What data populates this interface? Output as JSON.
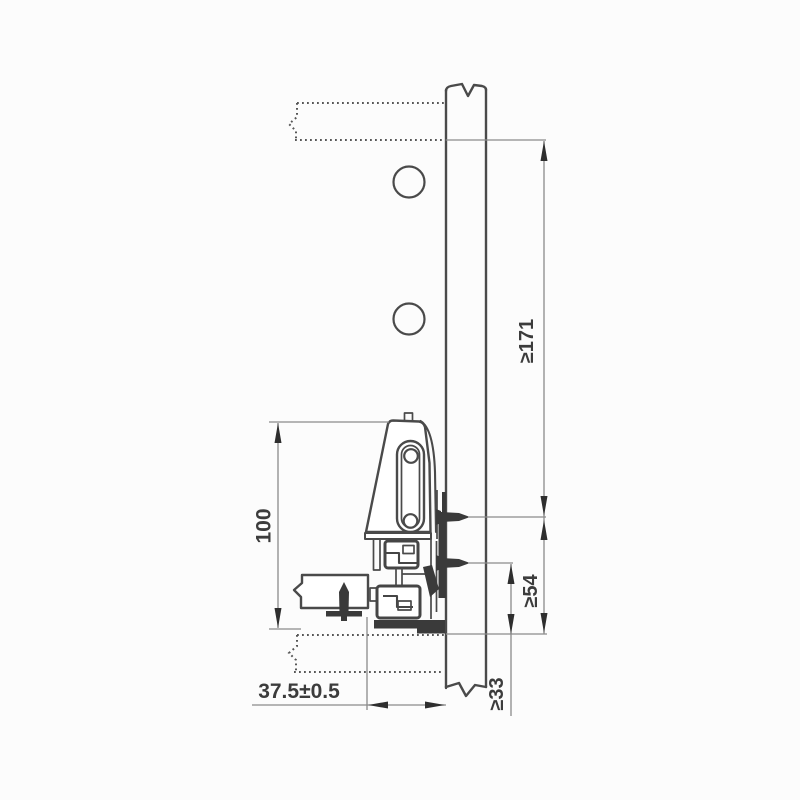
{
  "drawing": {
    "labels": {
      "side_height": "100",
      "horizontal_offset": "37.5±0.5",
      "panel_min_height": "≥171",
      "upper_screw_min": "≥54",
      "lower_screw_min": "≥33"
    },
    "colors": {
      "outline": "#4a4a4a",
      "dimension_line": "#8a8a8a",
      "dark_parts": "#3a3a3a",
      "label_text": "#3c3c3c",
      "background": "#fcfcfc"
    }
  }
}
